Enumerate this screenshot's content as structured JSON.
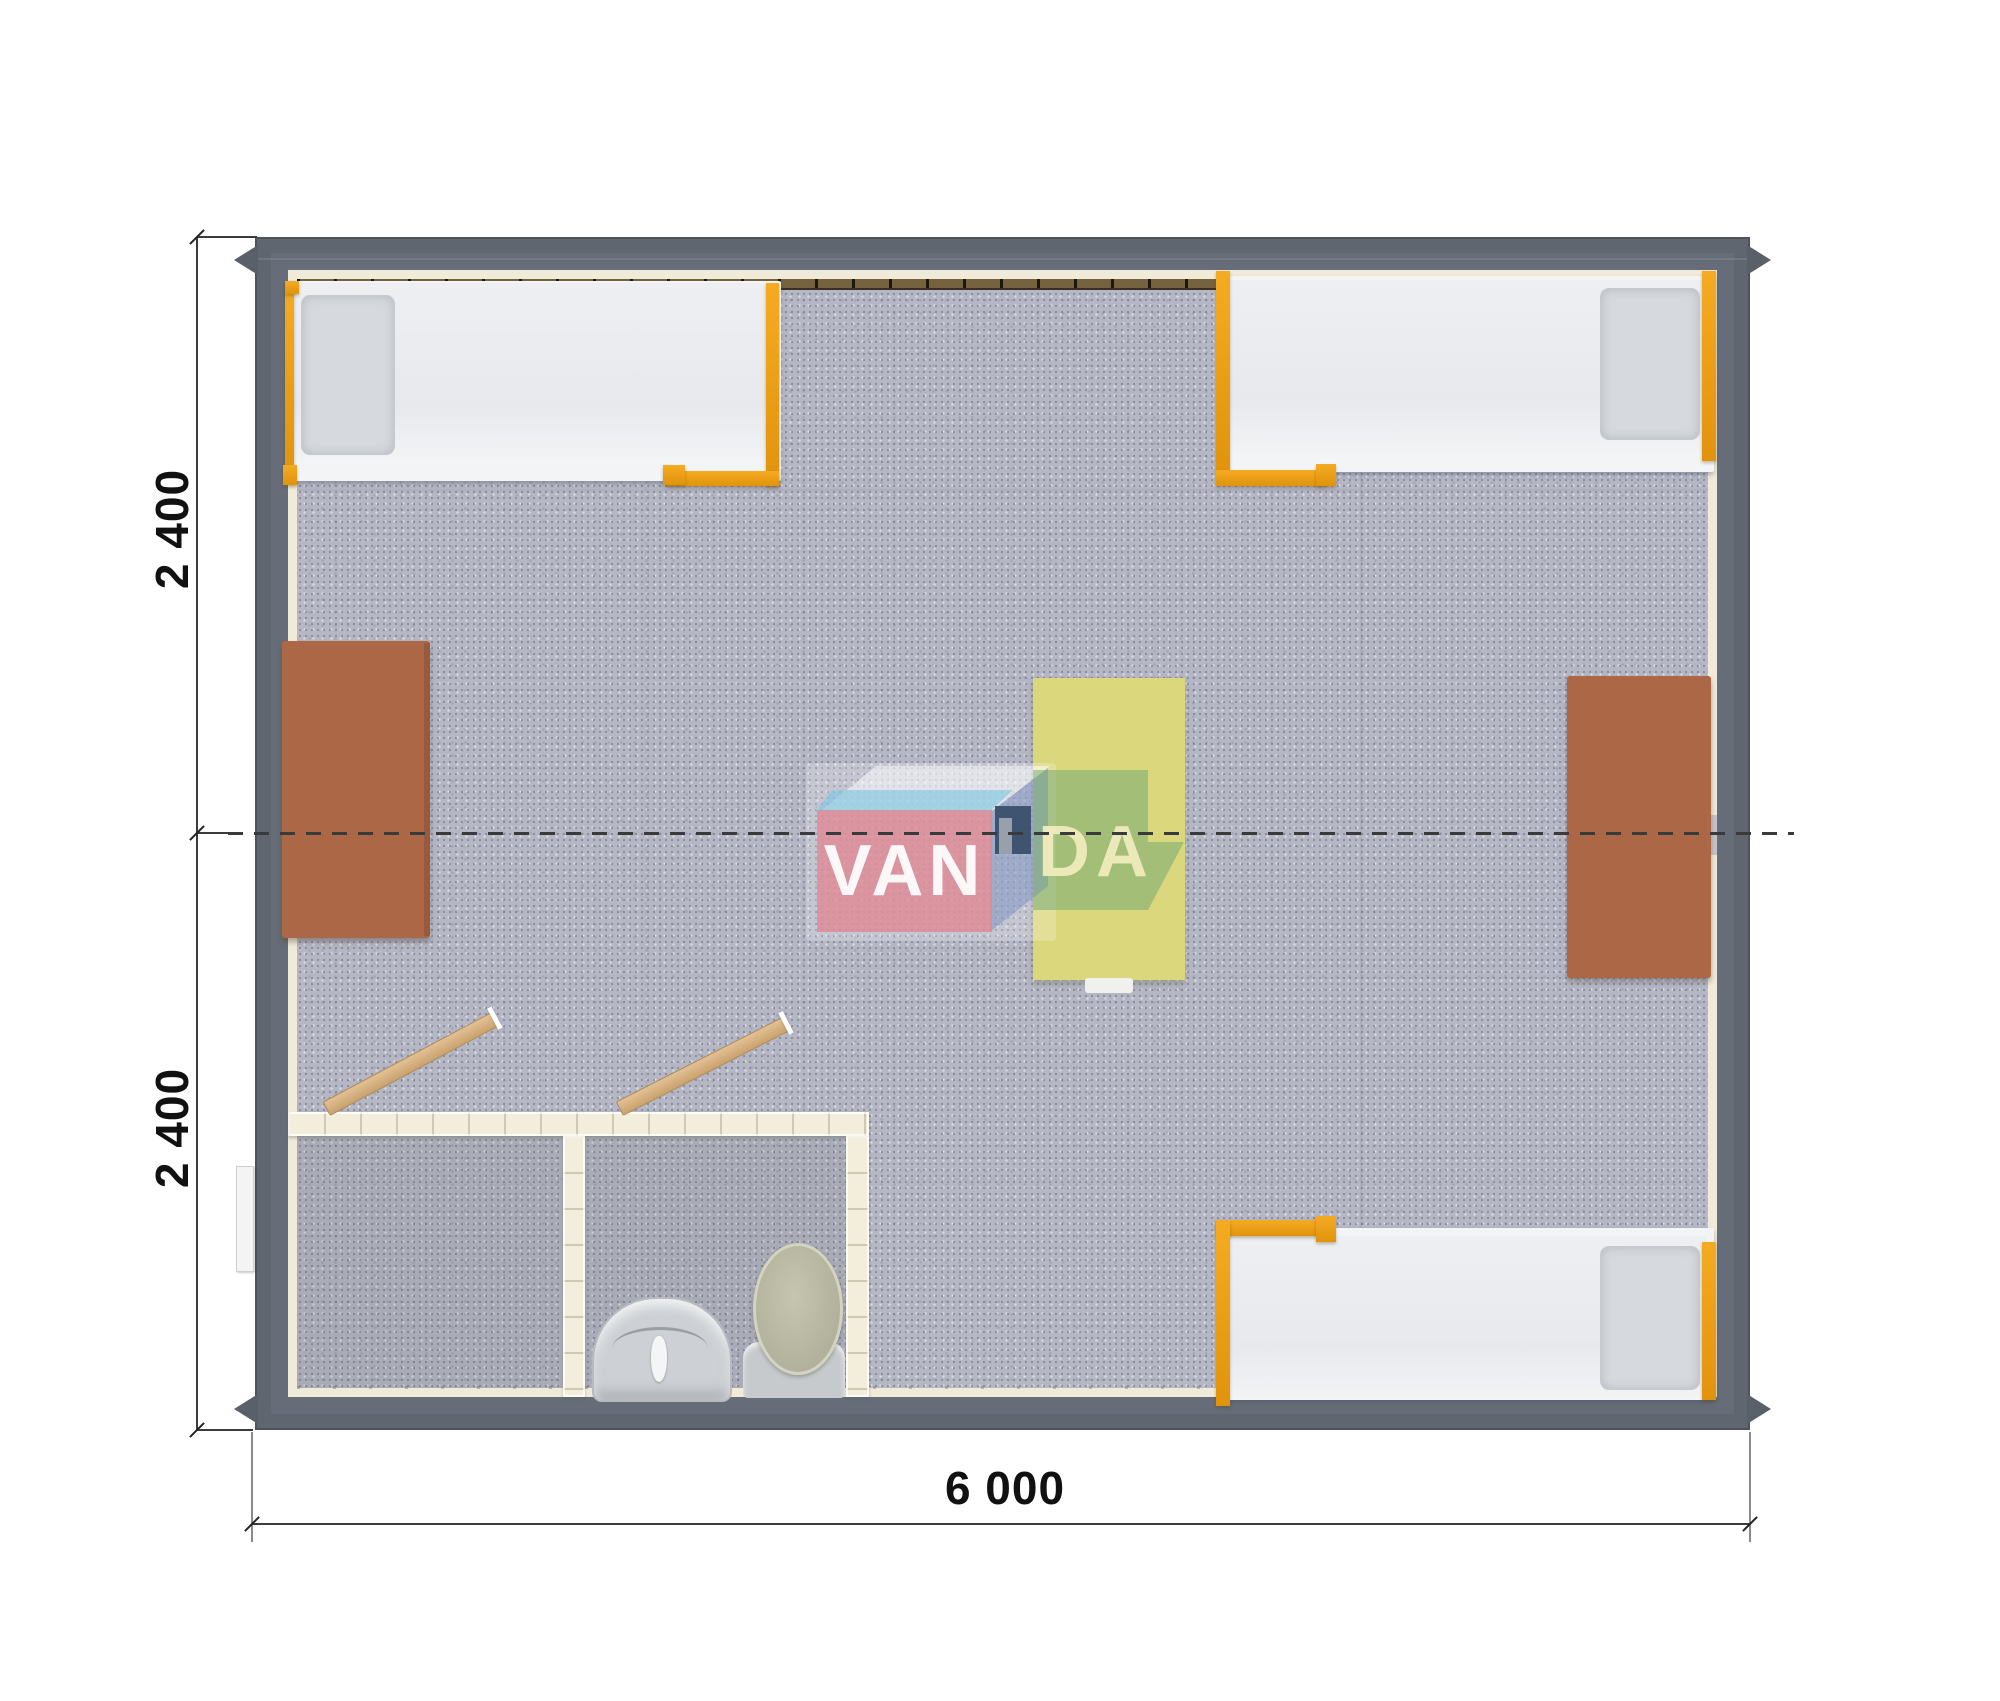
{
  "plan": {
    "title": "modular-cabin-floor-plan-top-view",
    "watermark": {
      "brand": "VANDA",
      "left": "VAN",
      "right": "DA"
    },
    "dimensions": {
      "left_top": "2 400",
      "left_bottom": "2 400",
      "bottom": "6 000"
    },
    "furniture_inventory": {
      "beds": 3,
      "desks": 2,
      "center_table": 1,
      "bathroom": {
        "rooms": 2,
        "toilet": 1,
        "sink": 1,
        "open_doors": 2
      }
    }
  },
  "colors": {
    "page": "#ffffff",
    "wall": "#666d78",
    "wall_dark": "#596069",
    "floor": "#b5b7c5",
    "liner": "#f0ead8",
    "window_strip": "#75633f",
    "accent_orange": "#ec9f17",
    "desk_brown": "#ac6746",
    "table_yellow": "#dbd77c",
    "bathroom_wall": "#f3eddc",
    "door_wood": "#d6b183",
    "mattress": "#e9ebef",
    "pillow": "#d6d9dd",
    "fixture_gray": "#cdd1d5",
    "toilet_olive": "#b8b8a2",
    "logo_pink": "#de8a96",
    "logo_sky": "#7dc6e2",
    "logo_side": "#8296c4",
    "logo_navy": "#3a4f6b",
    "logo_green": "#64a373",
    "logo_text": "#ffffff",
    "logo_text_secondary": "#efeaba",
    "dash_color": "#3a3a3a",
    "dim_color": "#111111"
  }
}
